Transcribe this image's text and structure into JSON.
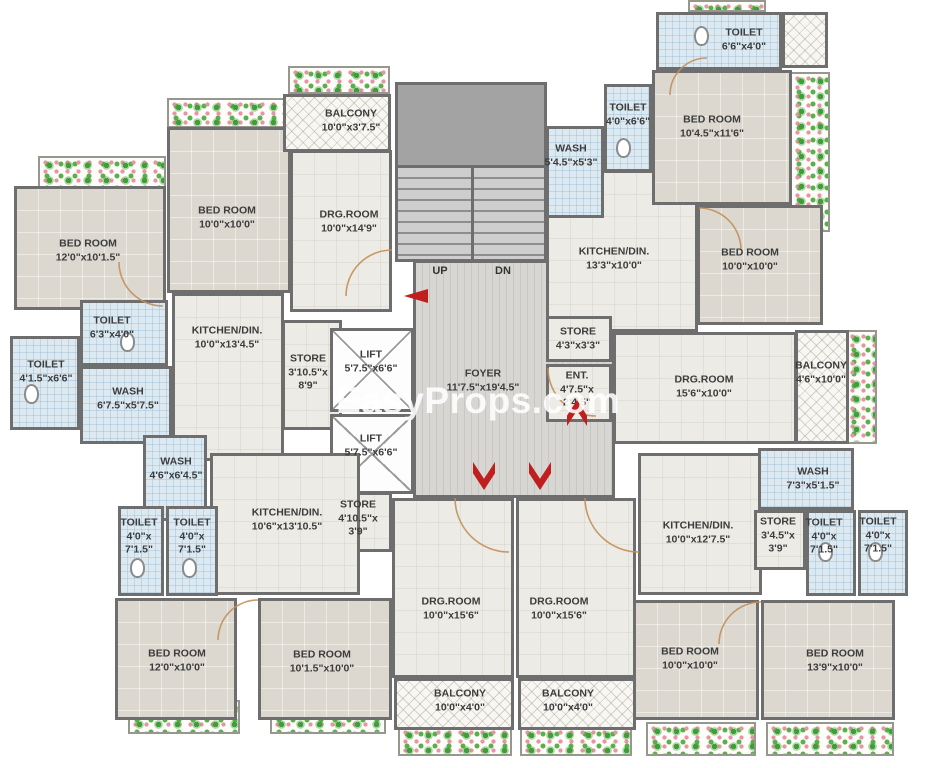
{
  "watermark": "EasyProps.com",
  "stairs": {
    "up": "UP",
    "dn": "DN"
  },
  "rooms": [
    {
      "id": "bedroom-tl-1",
      "label": "BED ROOM",
      "dims": "12'0\"x10'1.5\""
    },
    {
      "id": "bedroom-tl-2",
      "label": "BED ROOM",
      "dims": "10'0\"x10'0\""
    },
    {
      "id": "drg-tl",
      "label": "DRG.ROOM",
      "dims": "10'0\"x14'9\""
    },
    {
      "id": "balcony-tl",
      "label": "BALCONY",
      "dims": "10'0\"x3'7.5\""
    },
    {
      "id": "toilet-tl-a",
      "label": "TOILET",
      "dims": "6'3\"x4'0\""
    },
    {
      "id": "toilet-tl-b",
      "label": "TOILET",
      "dims": "4'1.5\"x6'6\""
    },
    {
      "id": "wash-tl",
      "label": "WASH",
      "dims": "6'7.5\"x5'7.5\""
    },
    {
      "id": "kitchen-tl",
      "label": "KITCHEN/DIN.",
      "dims": "10'0\"x13'4.5\""
    },
    {
      "id": "store-tl",
      "label": "STORE",
      "dims": "3'10.5\"x 8'9\""
    },
    {
      "id": "lift-1",
      "label": "LIFT",
      "dims": "5'7.5\"x6'6\""
    },
    {
      "id": "lift-2",
      "label": "LIFT",
      "dims": "5'7.5\"x6'6\""
    },
    {
      "id": "foyer",
      "label": "FOYER",
      "dims": "11'7.5\"x19'4.5\""
    },
    {
      "id": "store-center",
      "label": "STORE",
      "dims": "4'10.5\"x 3'9\""
    },
    {
      "id": "store-right",
      "label": "STORE",
      "dims": "4'3\"x3'3\""
    },
    {
      "id": "ent",
      "label": "ENT.",
      "dims": "4'7.5\"x 2'4.5\""
    },
    {
      "id": "wash-tr",
      "label": "WASH",
      "dims": "5'4.5\"x5'3\""
    },
    {
      "id": "toilet-tr-a",
      "label": "TOILET",
      "dims": "4'0\"x6'6\""
    },
    {
      "id": "toilet-tr-top",
      "label": "TOILET",
      "dims": "6'6\"x4'0\""
    },
    {
      "id": "bedroom-tr-1",
      "label": "BED ROOM",
      "dims": "10'4.5\"x11'6\""
    },
    {
      "id": "kitchen-tr",
      "label": "KITCHEN/DIN.",
      "dims": "13'3\"x10'0\""
    },
    {
      "id": "bedroom-tr-2",
      "label": "BED ROOM",
      "dims": "10'0\"x10'0\""
    },
    {
      "id": "drg-right",
      "label": "DRG.ROOM",
      "dims": "15'6\"x10'0\""
    },
    {
      "id": "balcony-right",
      "label": "BALCONY",
      "dims": "4'6\"x10'0\""
    },
    {
      "id": "wash-bl",
      "label": "WASH",
      "dims": "4'6\"x6'4.5\""
    },
    {
      "id": "toilet-bl-a",
      "label": "TOILET",
      "dims": "4'0\"x 7'1.5\""
    },
    {
      "id": "toilet-bl-b",
      "label": "TOILET",
      "dims": "4'0\"x 7'1.5\""
    },
    {
      "id": "kitchen-bl",
      "label": "KITCHEN/DIN.",
      "dims": "10'6\"x13'10.5\""
    },
    {
      "id": "bedroom-bl-1",
      "label": "BED ROOM",
      "dims": "12'0\"x10'0\""
    },
    {
      "id": "bedroom-bl-2",
      "label": "BED ROOM",
      "dims": "10'1.5\"x10'0\""
    },
    {
      "id": "drg-b1",
      "label": "DRG.ROOM",
      "dims": "10'0\"x15'6\""
    },
    {
      "id": "drg-b2",
      "label": "DRG.ROOM",
      "dims": "10'0\"x15'6\""
    },
    {
      "id": "balcony-b1",
      "label": "BALCONY",
      "dims": "10'0\"x4'0\""
    },
    {
      "id": "balcony-b2",
      "label": "BALCONY",
      "dims": "10'0\"x4'0\""
    },
    {
      "id": "kitchen-br",
      "label": "KITCHEN/DIN.",
      "dims": "10'0\"x12'7.5\""
    },
    {
      "id": "wash-br",
      "label": "WASH",
      "dims": "7'3\"x5'1.5\""
    },
    {
      "id": "store-br",
      "label": "STORE",
      "dims": "3'4.5\"x 3'9\""
    },
    {
      "id": "toilet-br-a",
      "label": "TOILET",
      "dims": "4'0\"x 7'1.5\""
    },
    {
      "id": "toilet-br-b",
      "label": "TOILET",
      "dims": "4'0\"x 7'1.5\""
    },
    {
      "id": "bedroom-br-1",
      "label": "BED ROOM",
      "dims": "10'0\"x10'0\""
    },
    {
      "id": "bedroom-br-2",
      "label": "BED ROOM",
      "dims": "13'9\"x10'0\""
    }
  ]
}
